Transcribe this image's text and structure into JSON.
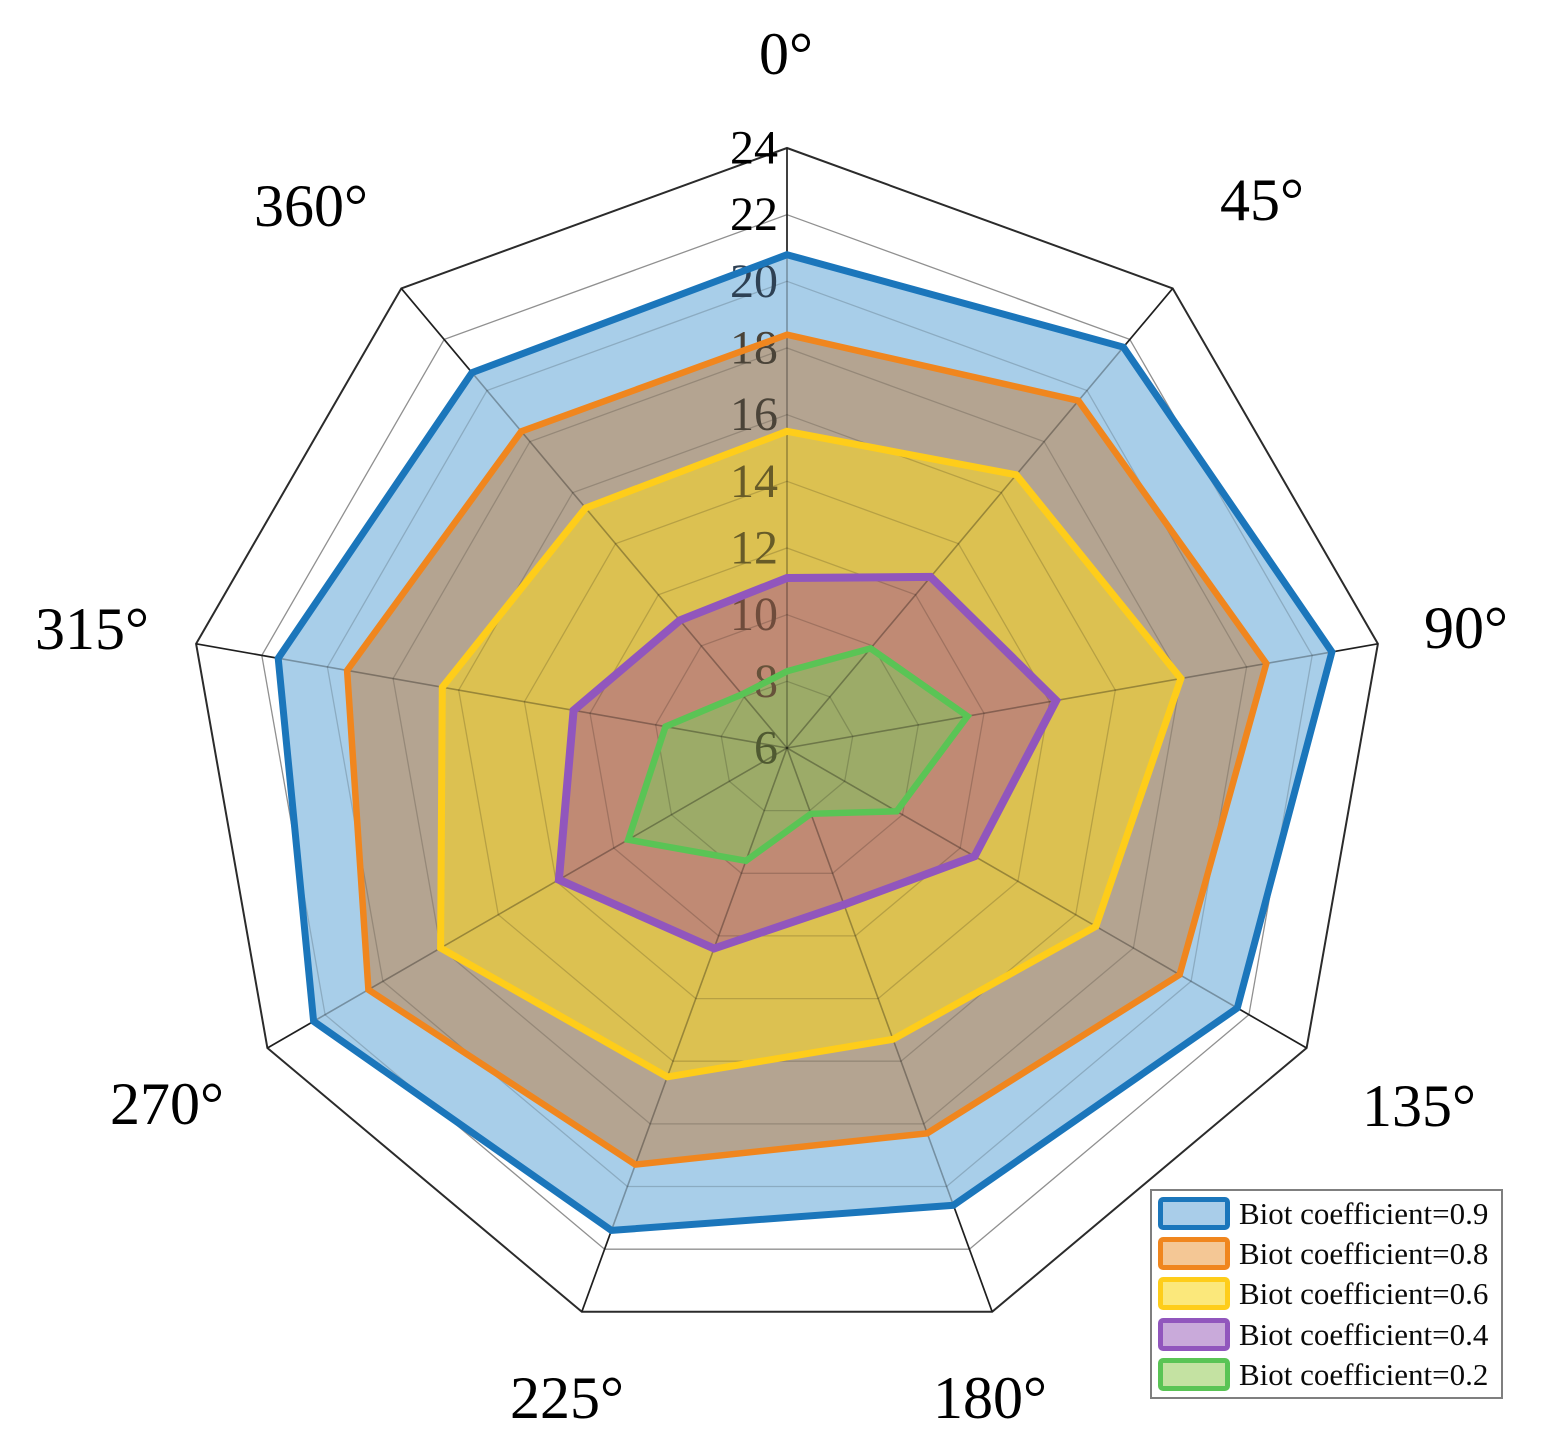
{
  "figure": {
    "background": "#ffffff"
  },
  "chart_data": {
    "type": "radar",
    "title": "",
    "angular_axis": {
      "labels": [
        "0°",
        "45°",
        "90°",
        "135°",
        "180°",
        "225°",
        "270°",
        "315°",
        "360°"
      ],
      "angles_screen_deg": [
        0,
        40,
        80,
        120,
        160,
        200,
        240,
        280,
        320
      ]
    },
    "radial_axis": {
      "min": 6,
      "max": 24,
      "tick_step": 2,
      "ticks": [
        {
          "value": 24,
          "label": "24",
          "label_color": "#000000"
        },
        {
          "value": 22,
          "label": "22",
          "label_color": "#000000"
        },
        {
          "value": 20,
          "label": "20",
          "label_color": "#2e4154"
        },
        {
          "value": 18,
          "label": "18",
          "label_color": "#4a4338"
        },
        {
          "value": 16,
          "label": "16",
          "label_color": "#4a4338"
        },
        {
          "value": 14,
          "label": "14",
          "label_color": "#675b28"
        },
        {
          "value": 12,
          "label": "12",
          "label_color": "#675b28"
        },
        {
          "value": 10,
          "label": "10",
          "label_color": "#6f4c3c"
        },
        {
          "value": 8,
          "label": "8",
          "label_color": "#66523a"
        },
        {
          "value": 6,
          "label": "6",
          "label_color": "#4f5931"
        }
      ]
    },
    "series": [
      {
        "name": "Biot coefficient=0.9",
        "color": "#1b76bb",
        "region_fill": "#a8cee9",
        "swatch_fill": "#a9cde9",
        "values": [
          20.8,
          21.7,
          22.6,
          21.6,
          20.6,
          21.4,
          22.4,
          21.5,
          20.7
        ]
      },
      {
        "name": "Biot coefficient=0.8",
        "color": "#f0861e",
        "region_fill": "#b4a491",
        "swatch_fill": "#f4c795",
        "values": [
          18.4,
          19.6,
          20.6,
          19.6,
          18.3,
          19.3,
          20.5,
          19.4,
          18.4
        ]
      },
      {
        "name": "Biot coefficient=0.6",
        "color": "#fecd1a",
        "region_fill": "#dcc151",
        "swatch_fill": "#fbe87b",
        "values": [
          15.5,
          16.7,
          18.0,
          16.7,
          15.3,
          16.5,
          18.0,
          16.5,
          15.4
        ]
      },
      {
        "name": "Biot coefficient=0.4",
        "color": "#9156bd",
        "region_fill": "#c08a74",
        "swatch_fill": "#c9aada",
        "values": [
          11.1,
          12.7,
          14.2,
          12.5,
          11.0,
          12.4,
          13.9,
          12.5,
          11.0
        ]
      },
      {
        "name": "Biot coefficient=0.2",
        "color": "#5ac455",
        "region_fill": "#9cab68",
        "swatch_fill": "#c4e2a2",
        "values": [
          8.3,
          9.9,
          11.5,
          9.8,
          8.1,
          9.6,
          11.5,
          9.7,
          8.1
        ]
      }
    ],
    "legend": {
      "position": "lower-right",
      "border_color": "#7f7f7f",
      "background": "#ffffff"
    },
    "grid": {
      "on": true,
      "ring_color": "#909090",
      "spoke_color": "#1f1f1f",
      "frame_color": "#2b2b2b"
    }
  }
}
